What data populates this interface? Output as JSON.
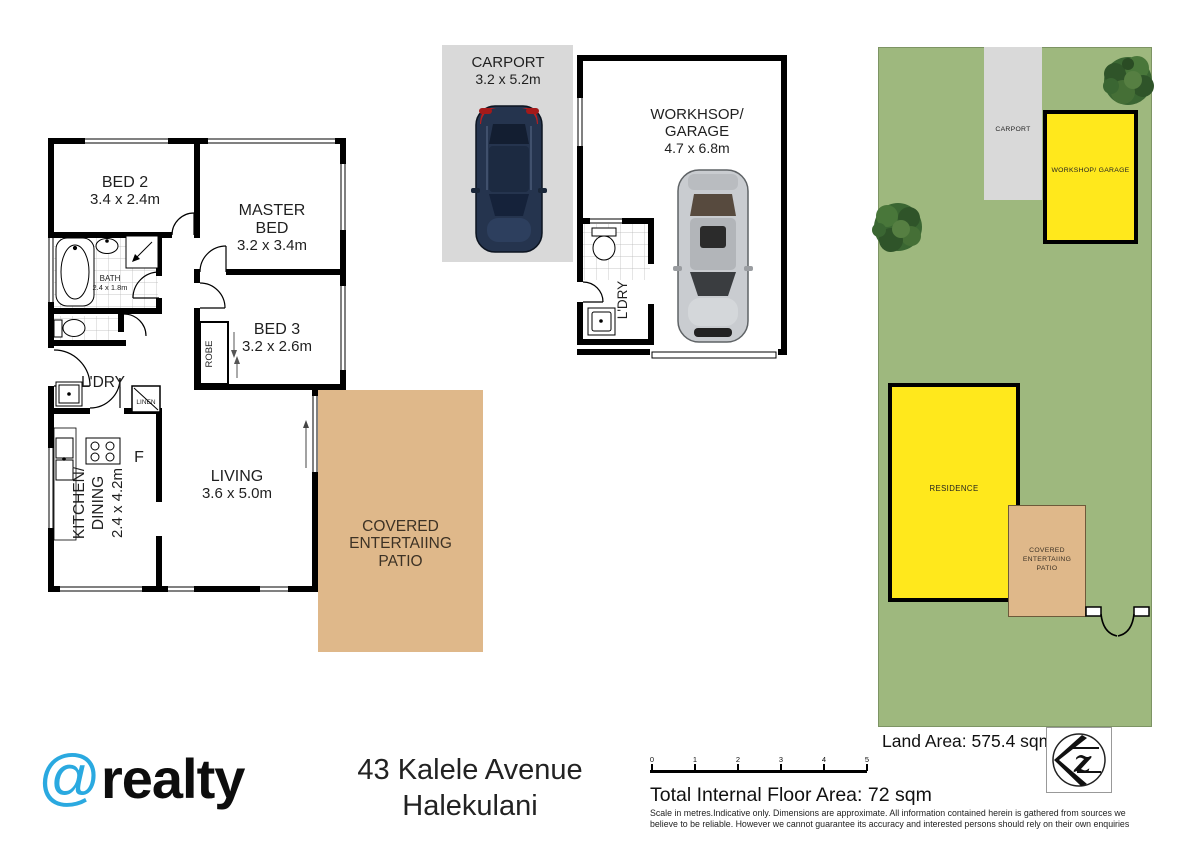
{
  "colors": {
    "site_green": "#9EB87E",
    "building_yellow": "#FFE81C",
    "patio_tan": "#DFB88A",
    "carport_gray": "#D9D9D9",
    "brand_blue": "#2AA9E0",
    "wall_black": "#000000"
  },
  "main_plan": {
    "bed2": {
      "name": "BED 2",
      "dims": "3.4 x 2.4m"
    },
    "master": {
      "name": "MASTER BED",
      "dims": "3.2 x 3.4m"
    },
    "bath": {
      "name": "BATH",
      "dims": "2.4 x 1.8m"
    },
    "bed3": {
      "name": "BED 3",
      "dims": "3.2 x 2.6m"
    },
    "robe": {
      "name": "ROBE"
    },
    "ldry": {
      "name": "L'DRY"
    },
    "linen": {
      "name": "LINEN"
    },
    "fridge": {
      "name": "F"
    },
    "kitchen": {
      "line1": "KITCHEN/",
      "line2": "DINING",
      "dims": "2.4 x 4.2m"
    },
    "living": {
      "name": "LIVING",
      "dims": "3.6 x 5.0m"
    },
    "patio": {
      "name": "COVERED ENTERTAIING PATIO"
    }
  },
  "garage_plan": {
    "carport": {
      "name": "CARPORT",
      "dims": "3.2 x 5.2m"
    },
    "workshop": {
      "name": "WORKHSOP/ GARAGE",
      "dims": "4.7 x 6.8m"
    },
    "ldry": {
      "name": "L'DRY"
    }
  },
  "site_plan": {
    "carport": "CARPORT",
    "workshop": "WORKSHOP/ GARAGE",
    "residence": "RESIDENCE",
    "patio": "COVERED ENTERTAIING PATIO",
    "land_area": "Land Area: 575.4 sqm"
  },
  "footer": {
    "brand_at": "@",
    "brand_name": "realty",
    "address_line1": "43 Kalele Avenue",
    "address_line2": "Halekulani",
    "scale_ticks": [
      "0",
      "1",
      "2",
      "3",
      "4",
      "5"
    ],
    "floor_area": "Total Internal Floor Area: 72 sqm",
    "disclaimer_line1": "Scale in metres.Indicative only. Dimensions are approximate. All information contained herein is gathered from sources we",
    "disclaimer_line2": "believe to be reliable. However we cannot guarantee its accuracy and interested persons should rely on their own enquiries"
  }
}
